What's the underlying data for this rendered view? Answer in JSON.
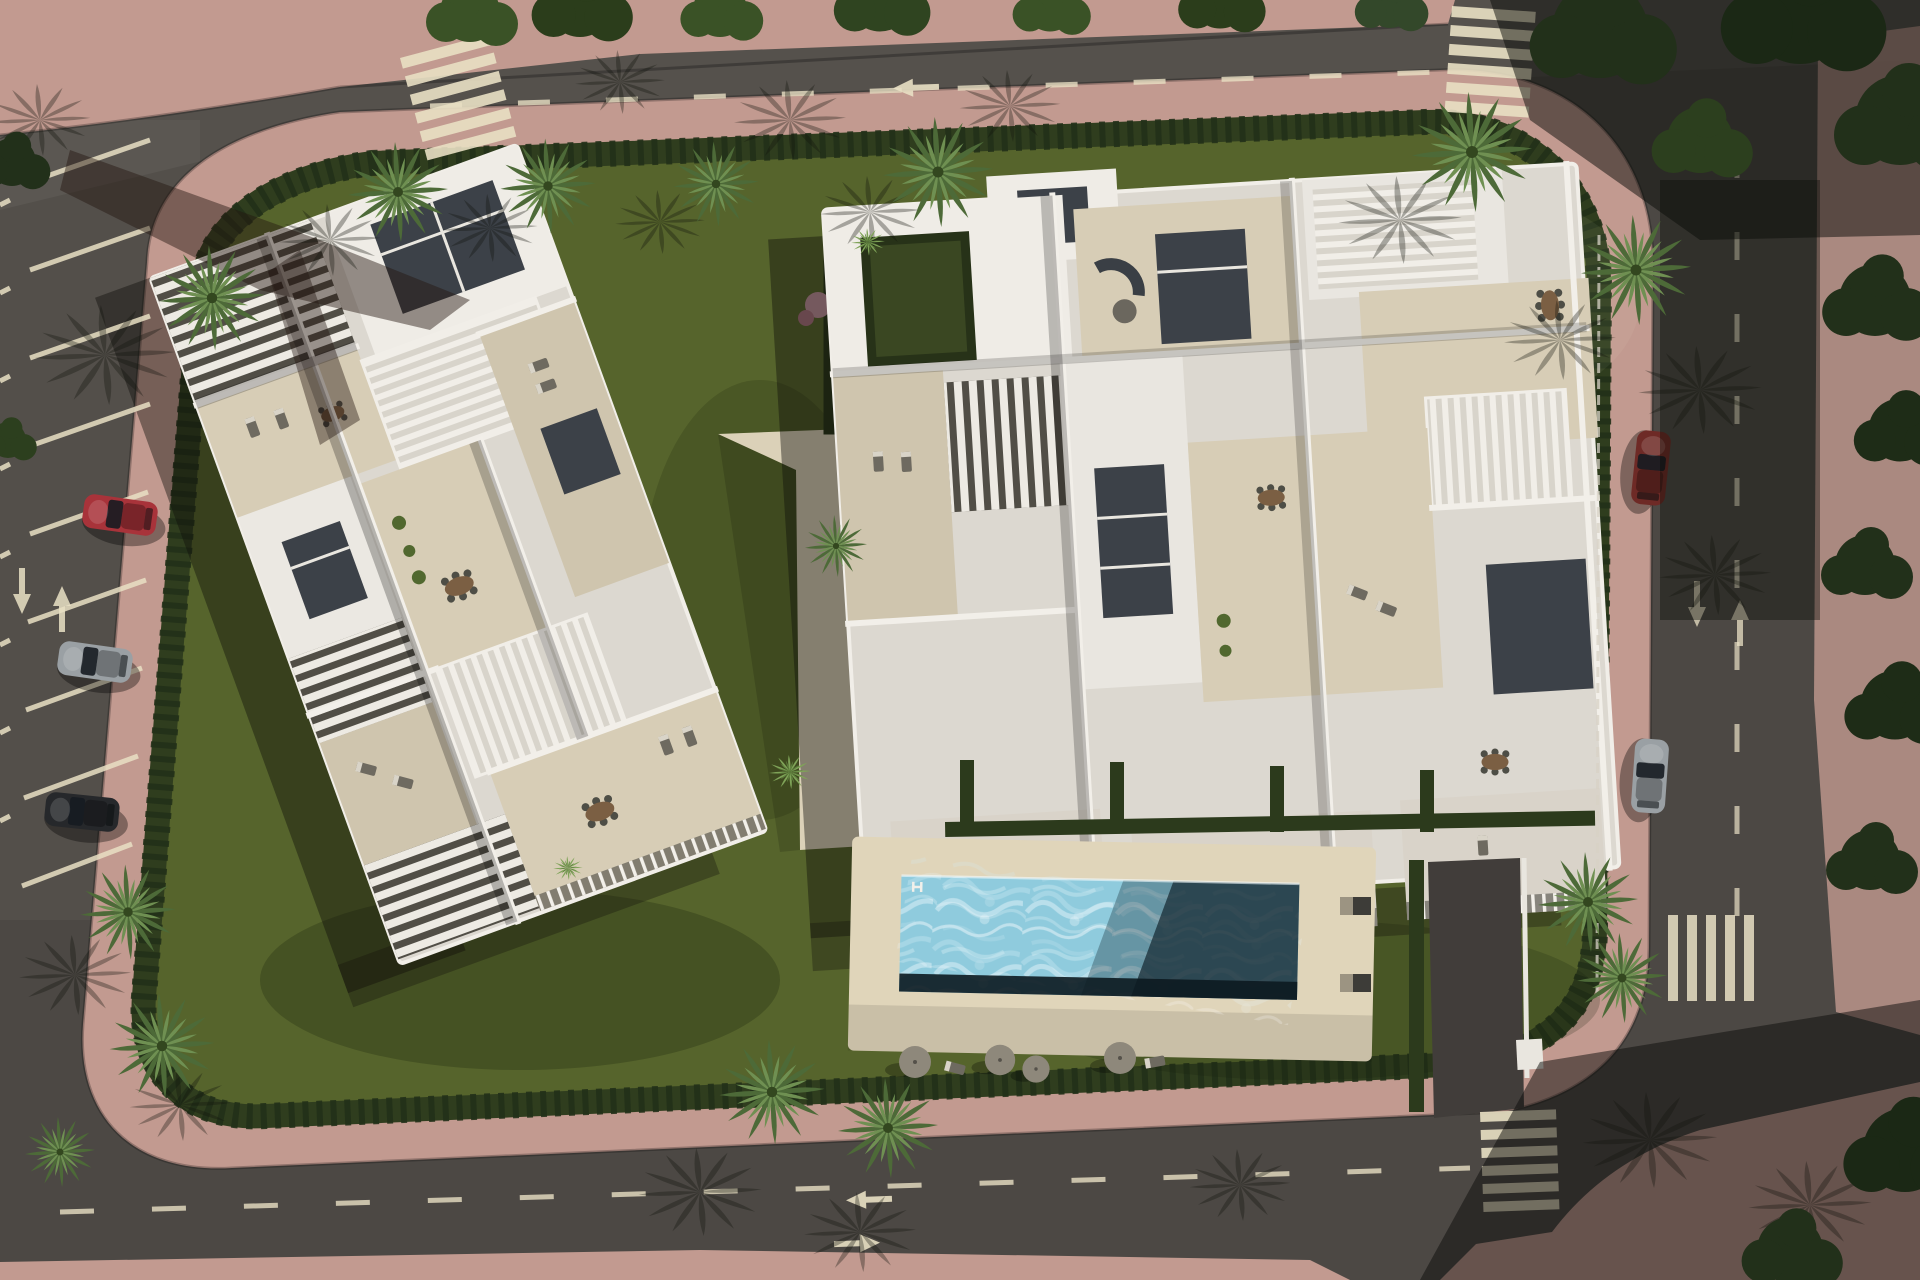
{
  "scene": {
    "type": "aerial-architectural-render",
    "description": "Bird's-eye 3D rendering of a modern residential development: two white apartment buildings with rooftop terraces and pergolas, a rectangular communal swimming pool with sun deck, landscaped gardens with palm trees and hedges, ringed by pink pedestrian sidewalks and asphalt streets with angled parking, lane arrows, dashed lane lines and zebra crosswalks"
  },
  "colors": {
    "asphalt": "#4c4844",
    "asphaltShade": "#33302d",
    "sidewalk": "#c29a90",
    "sidewalkShade": "#97746e",
    "grass": "#56642c",
    "grassShade": "#42511f",
    "hedge": "#2c3a1c",
    "building": "#dcd8d0",
    "roofWhite": "#efece6",
    "terrace": "#d7cdb6",
    "terraceAlt": "#cfc5ae",
    "courtyard": "#3c4148",
    "poolDeck": "#e0d5ba",
    "poolWater": "#8fcbdd",
    "poolShade": "#1b303a",
    "marking": "#e9e0c4",
    "palm": "#4d6a38",
    "palmLight": "#6f9052",
    "canopyDark": "#22301a",
    "carRed": "#a8333a",
    "carSilver": "#9aa0a4",
    "carDark": "#26282b",
    "carMaroon": "#6e2a26"
  },
  "objects": {
    "buildings": [
      {
        "name": "west building",
        "features": "rooftop terraces, pergolas, ribbed roof sections, inner courtyards"
      },
      {
        "name": "east building",
        "features": "rooftop terraces, louvered pergolas, balconies with railings, private gardens"
      }
    ],
    "pool": {
      "shape": "rectangular",
      "deck": "beige sun deck",
      "surroundings": "lawn with parasols and loungers"
    },
    "cars": [
      {
        "color_name": "red",
        "location": "west street angled parking"
      },
      {
        "color_name": "silver",
        "location": "west street angled parking"
      },
      {
        "color_name": "dark gray",
        "location": "west street angled parking"
      },
      {
        "color_name": "maroon",
        "location": "east street curb"
      },
      {
        "color_name": "silver",
        "location": "east street curb"
      }
    ],
    "crosswalks": 4,
    "lane_arrows": 7,
    "palm_trees": 14
  }
}
